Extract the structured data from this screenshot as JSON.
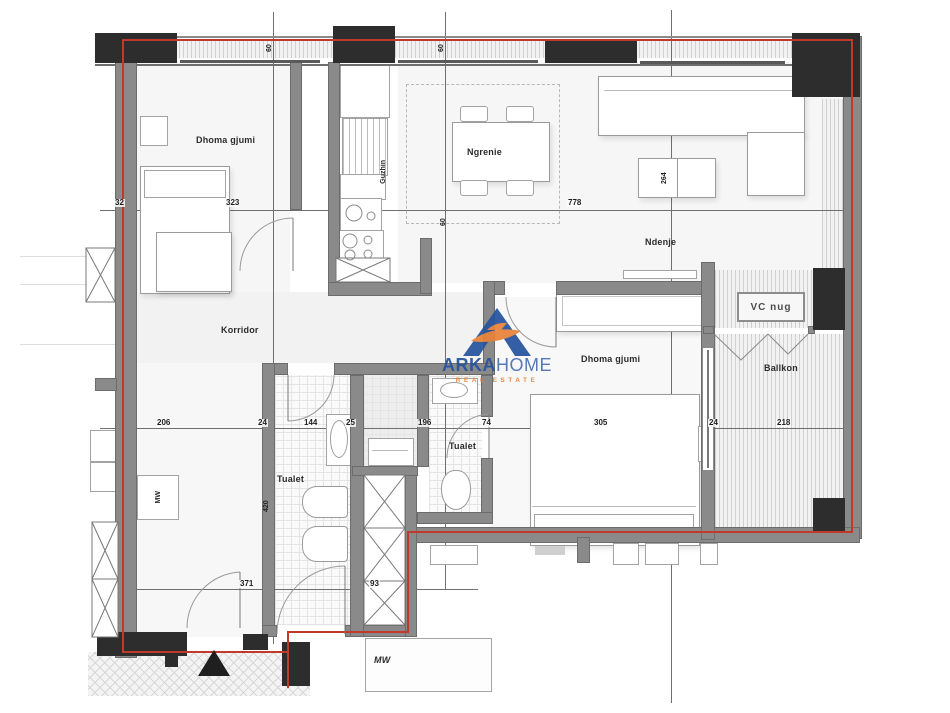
{
  "brand": {
    "name_bold": "ARKA",
    "name_light": "HOME",
    "tagline": "REAL ESTATE"
  },
  "rooms": {
    "bedroom_top_left": "Dhoma gjumi",
    "kitchen": "Guzhin",
    "dining": "Ngrenie",
    "living": "Ndenje",
    "corridor": "Korridor",
    "bedroom_right": "Dhoma gjumi",
    "balcony": "Ballkon",
    "toilet_left": "Tualet",
    "toilet_right": "Tualet",
    "wc": "VC nug"
  },
  "appliances": {
    "washing_machine_left": "MW",
    "washing_machine_bottom": "MW"
  },
  "dimensions": {
    "line_top": {
      "d32": "32",
      "d323": "323",
      "d778": "778"
    },
    "line_middle": {
      "d206": "206",
      "d24a": "24",
      "d144": "144",
      "d25": "25",
      "d196": "196",
      "d74": "74",
      "d305": "305",
      "d24b": "24",
      "d218": "218"
    },
    "line_bottom": {
      "d371": "371",
      "d93": "93"
    },
    "small": {
      "top_a": "60",
      "top_b": "60",
      "mid": "60",
      "bath": "420",
      "table": "264"
    }
  },
  "colors": {
    "boundary_red": "#c0392b",
    "wall_gray": "#8a8a8a",
    "column_dark": "#2d2d2d",
    "brand_blue": "#27549e",
    "brand_orange": "#e8833a"
  }
}
